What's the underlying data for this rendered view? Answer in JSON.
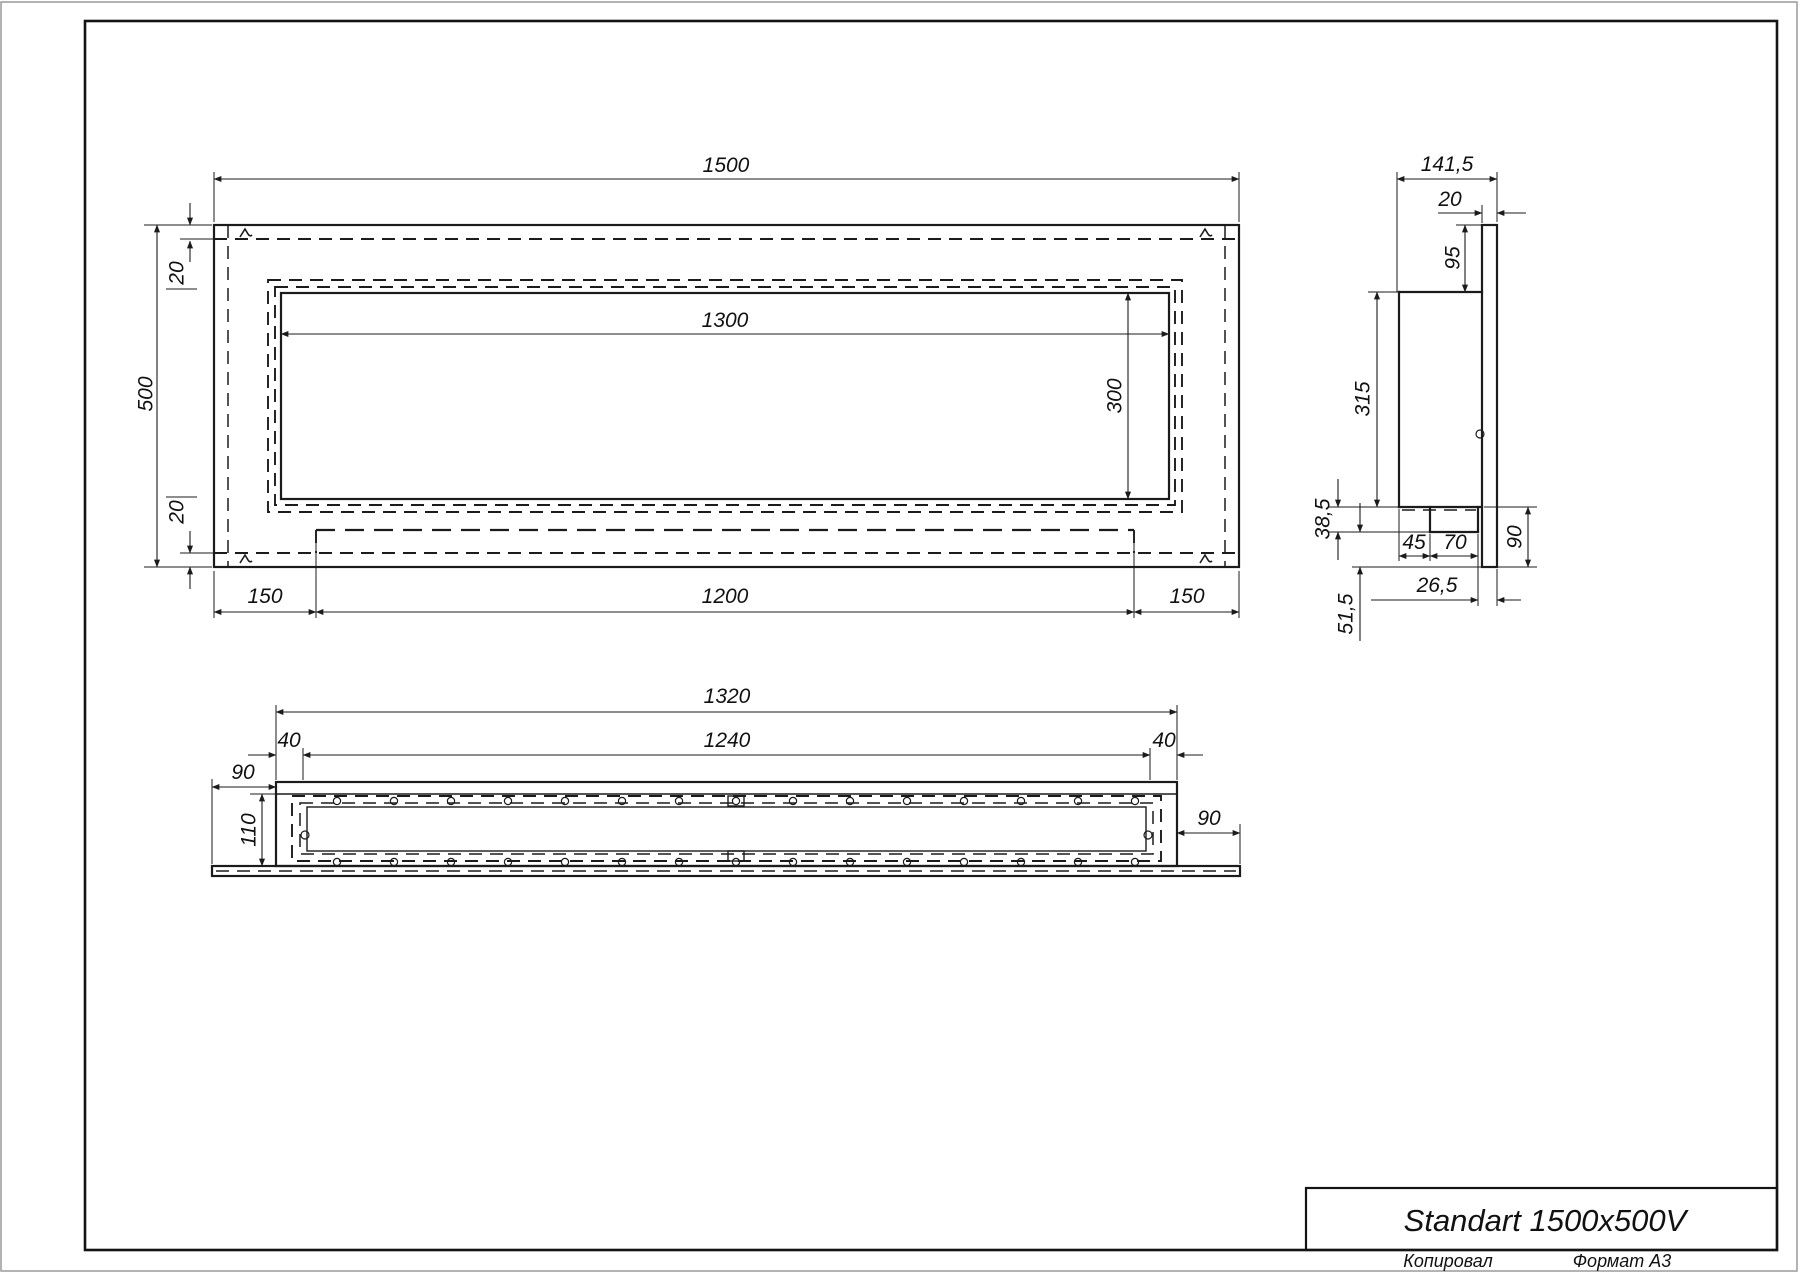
{
  "drawing": {
    "title": "Standart 1500x500V",
    "footer": {
      "copied": "Копировал",
      "format": "Формат A3"
    }
  },
  "views": {
    "front": {
      "overall_width": "1500",
      "overall_height": "500",
      "opening_width": "1300",
      "opening_height": "300",
      "top_offset": "20",
      "bottom_offset": "20",
      "bottom_left": "150",
      "bottom_center": "1200",
      "bottom_right": "150"
    },
    "side": {
      "depth": "141,5",
      "panel_thickness": "20",
      "top_lip": "95",
      "body_height": "315",
      "channel_drop": "38,5",
      "channel_left": "45",
      "channel_width": "70",
      "lower_lip": "90",
      "front_gap": "26,5",
      "panel_drop": "51,5"
    },
    "bottom": {
      "body_width": "1320",
      "inner_width": "1240",
      "left_wall": "40",
      "right_wall": "40",
      "left_flange": "90",
      "right_flange": "90",
      "body_depth": "110"
    }
  },
  "dimension_labels": [
    {
      "id": "front-width",
      "view": "front",
      "text": "1500",
      "x": 726,
      "y": 172,
      "rot": 0
    },
    {
      "id": "front-top-offset",
      "view": "front",
      "text": "20",
      "x": 176,
      "y": 273,
      "rot": 1
    },
    {
      "id": "front-height",
      "view": "front",
      "text": "500",
      "x": 145,
      "y": 394,
      "rot": 1
    },
    {
      "id": "opening-width",
      "view": "front",
      "text": "1300",
      "x": 725,
      "y": 327,
      "rot": 0
    },
    {
      "id": "opening-height",
      "view": "front",
      "text": "300",
      "x": 1114,
      "y": 396,
      "rot": 1
    },
    {
      "id": "front-bottom-offset",
      "view": "front",
      "text": "20",
      "x": 176,
      "y": 512,
      "rot": 1
    },
    {
      "id": "front-left-150",
      "view": "front",
      "text": "150",
      "x": 265,
      "y": 603,
      "rot": 0
    },
    {
      "id": "front-bottom-1200",
      "view": "front",
      "text": "1200",
      "x": 725,
      "y": 603,
      "rot": 0
    },
    {
      "id": "front-right-150",
      "view": "front",
      "text": "150",
      "x": 1187,
      "y": 603,
      "rot": 0
    },
    {
      "id": "side-depth",
      "view": "side",
      "text": "141,5",
      "x": 1447,
      "y": 171,
      "rot": 0
    },
    {
      "id": "side-panel-20",
      "view": "side",
      "text": "20",
      "x": 1450,
      "y": 206,
      "rot": 0
    },
    {
      "id": "side-top-95",
      "view": "side",
      "text": "95",
      "x": 1452,
      "y": 258,
      "rot": 1
    },
    {
      "id": "side-body-315",
      "view": "side",
      "text": "315",
      "x": 1362,
      "y": 399,
      "rot": 1
    },
    {
      "id": "side-38-5",
      "view": "side",
      "text": "38,5",
      "x": 1322,
      "y": 519,
      "rot": 1
    },
    {
      "id": "side-45",
      "view": "side",
      "text": "45",
      "x": 1414,
      "y": 549,
      "rot": 0
    },
    {
      "id": "side-70",
      "view": "side",
      "text": "70",
      "x": 1455,
      "y": 549,
      "rot": 0
    },
    {
      "id": "side-right-90",
      "view": "side",
      "text": "90",
      "x": 1514,
      "y": 537,
      "rot": 1
    },
    {
      "id": "side-26-5",
      "view": "side",
      "text": "26,5",
      "x": 1437,
      "y": 592,
      "rot": 0
    },
    {
      "id": "side-51-5",
      "view": "side",
      "text": "51,5",
      "x": 1345,
      "y": 614,
      "rot": 1
    },
    {
      "id": "bottom-1320",
      "view": "bottom",
      "text": "1320",
      "x": 727,
      "y": 703,
      "rot": 0
    },
    {
      "id": "bottom-1240",
      "view": "bottom",
      "text": "1240",
      "x": 727,
      "y": 747,
      "rot": 0
    },
    {
      "id": "bottom-left-40",
      "view": "bottom",
      "text": "40",
      "x": 289,
      "y": 747,
      "rot": 0
    },
    {
      "id": "bottom-right-40",
      "view": "bottom",
      "text": "40",
      "x": 1164,
      "y": 747,
      "rot": 0
    },
    {
      "id": "bottom-left-90",
      "view": "bottom",
      "text": "90",
      "x": 243,
      "y": 779,
      "rot": 0
    },
    {
      "id": "bottom-110",
      "view": "bottom",
      "text": "110",
      "x": 248,
      "y": 830,
      "rot": 1
    },
    {
      "id": "bottom-right-90",
      "view": "bottom",
      "text": "90",
      "x": 1209,
      "y": 825,
      "rot": 0
    }
  ]
}
